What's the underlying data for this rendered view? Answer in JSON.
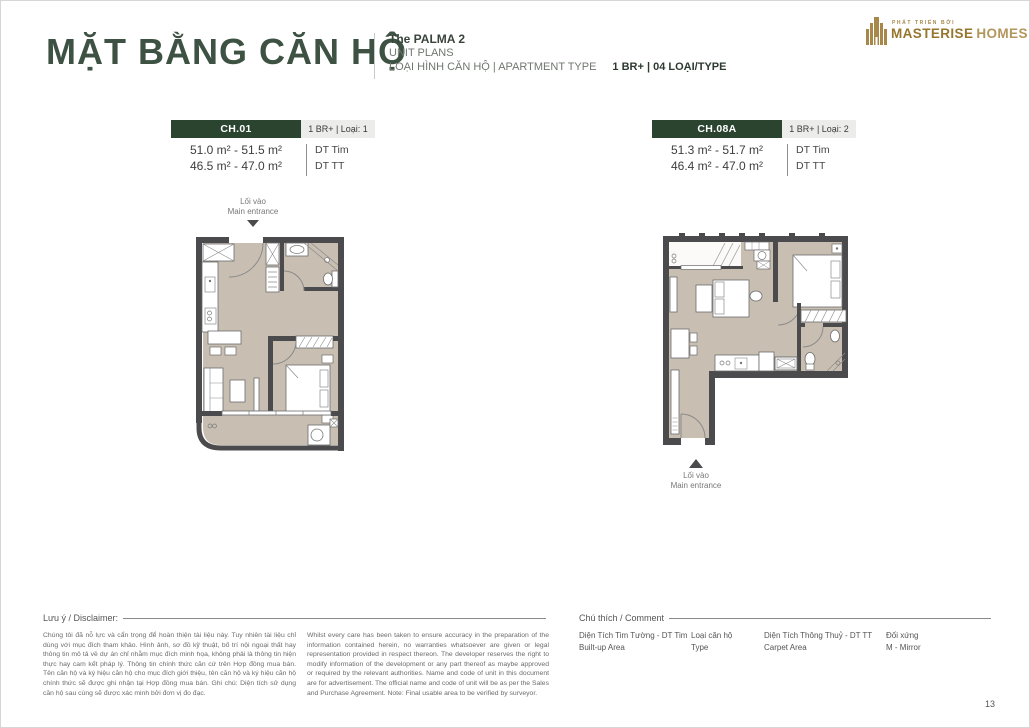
{
  "header": {
    "title": "MẶT BẰNG CĂN HỘ",
    "project_name": "The PALMA 2",
    "project_subtitle": "UNIT PLANS",
    "type_label": "LOẠI HÌNH CĂN HỘ  |  APARTMENT TYPE",
    "type_value": "1 BR+  |  04 LOẠI/TYPE",
    "logo_tagline": "PHÁT TRIỂN BỞI",
    "logo_brand_1": "MASTERISE",
    "logo_brand_2": "HOMES"
  },
  "units": [
    {
      "code": "CH.01",
      "type_tag": "1 BR+ | Loại: 1",
      "builtup_area": "51.0 m² - 51.5 m²",
      "carpet_area": "46.5 m² - 47.0 m²",
      "builtup_label": "DT Tim",
      "carpet_label": "DT TT",
      "entrance_vi": "Lối vào",
      "entrance_en": "Main entrance"
    },
    {
      "code": "CH.08A",
      "type_tag": "1 BR+ | Loại: 2",
      "builtup_area": "51.3 m² - 51.7 m²",
      "carpet_area": "46.4 m² - 47.0 m²",
      "builtup_label": "DT Tim",
      "carpet_label": "DT TT",
      "entrance_vi": "Lối vào",
      "entrance_en": "Main entrance"
    }
  ],
  "disclaimer": {
    "label": "Lưu ý / Disclaimer:",
    "text_vi": "Chúng tôi đã nỗ lực và cẩn trọng để hoàn thiện tài liệu này. Tuy nhiên tài liệu chỉ dùng với mục đích tham khảo. Hình ảnh, sơ đồ kỹ thuật, bố trí nội ngoại thất hay thông tin mô tả về dự án chỉ nhằm mục đích minh họa, không phải là thông tin hiện thực hay cam kết pháp lý. Thông tin chính thức căn cứ trên Hợp đồng mua bán. Tên căn hộ và ký hiệu căn hộ cho mục đích giới thiệu, tên căn hộ và ký hiệu căn hộ chính thức sẽ được ghi nhận tại Hợp đồng mua bán. Ghi chú: Diện tích sử dụng căn hộ sau cùng sẽ được xác minh bởi đơn vị đo đạc.",
    "text_en": "Whilst every care has been taken to ensure accuracy in the preparation of the information contained herein, no warranties whatsoever are given or legal representation provided in respect thereon. The developer reserves the right to modify information of the development or any part thereof as maybe approved or required by the relevant authorities. Name and code of unit in this document are for advertisement. The official name and code of unit will be as per the Sales and Purchase Agreement. Note: Final usable area to be verified by surveyor."
  },
  "legend": {
    "label": "Chú thích / Comment",
    "items": [
      {
        "line1": "Diện Tích Tim Tường - DT Tim",
        "line2": "Built-up Area"
      },
      {
        "line1": "Loại căn hộ",
        "line2": "Type"
      },
      {
        "line1": "Diện Tích Thông Thuỷ - DT TT",
        "line2": "Carpet Area"
      },
      {
        "line1": "Đối xứng",
        "line2": "M - Mirror"
      }
    ]
  },
  "page_number": "13",
  "colors": {
    "brand_green": "#2a4430",
    "title_green": "#3e5243",
    "gold": "#a8874b",
    "wall": "#4b4b4d",
    "floor": "#c8bfb2"
  }
}
